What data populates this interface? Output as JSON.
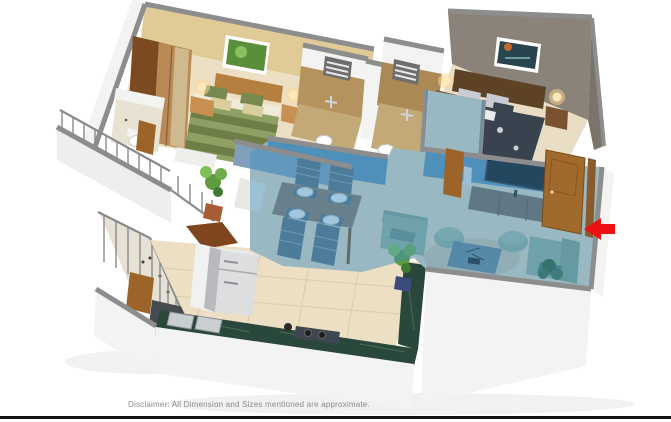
{
  "page": {
    "background_color": "#ffffff",
    "bottom_border_color": "#141414"
  },
  "disclaimer": {
    "text": "Disclaimer: All Dimension and Sizes mentioned are approximate.",
    "color": "#8a8a8a"
  },
  "floor_plan": {
    "entrance_arrow_icon": "left-arrow-icon",
    "entrance_arrow_color": "#ee1111",
    "highlight_color": "#3e8fc0",
    "palette": {
      "wall_white": "#f3f3f1",
      "wall_top": "#8d8d8d",
      "bedroom_wall": "#e0cb97",
      "master_wall": "#8b8379",
      "master_wall_dark": "#7b746b",
      "floor_cream": "#ecdfc4",
      "floor_hall": "#e4dac2",
      "tile_brown": "#b5935e",
      "tile_floor": "#c4a978",
      "wood": "#a56b2f",
      "wood_dark": "#6b4a2e",
      "wood_light": "#b98a55",
      "bed_green": "#8fa065",
      "bed_green_dark": "#6d7f46",
      "bed_navy": "#39424f",
      "sofa_green": "#9ab29b",
      "sofa_green_dark": "#87a388",
      "plant_green": "#5f9c3f",
      "marble_green": "#2a473b",
      "fridge_silver": "#dcdee0",
      "lamp_glow": "#ffd98f",
      "blue_wall": "#5d93b4",
      "parapet_white": "#eceef0",
      "railing": "#8a8a8a"
    }
  }
}
